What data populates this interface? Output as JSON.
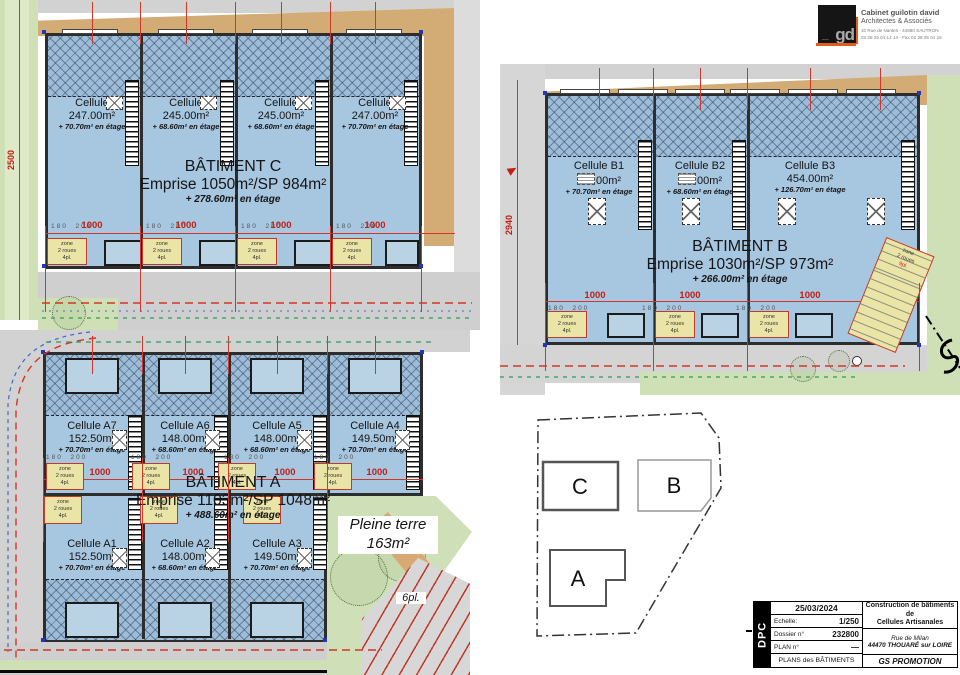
{
  "logo": {
    "monogram": "gd",
    "line1": "Cabinet guilotin david",
    "line2": "Architectes & Associés",
    "line3": "10 Rue de Nantes - 44880 SAUTRON",
    "line4": "02 28 25 01 14 14 - Fax 02 28 25 01 15"
  },
  "plan_c": {
    "title": "BÂTIMENT C",
    "emprise": "Emprise 1050m²/SP 984m²",
    "etage": "+ 278.60m² en étage",
    "side_dim": "2500",
    "dim_1000": "1000",
    "dim_pair": "180  200",
    "cells": [
      {
        "name": "Cellule",
        "area": "247.00m²",
        "floor": "+ 70.70m² en étage"
      },
      {
        "name": "Cellule",
        "area": "245.00m²",
        "floor": "+ 68.60m² en étage"
      },
      {
        "name": "Cellule",
        "area": "245.00m²",
        "floor": "+ 68.60m² en étage"
      },
      {
        "name": "Cellule",
        "area": "247.00m²",
        "floor": "+ 70.70m² en étage"
      }
    ]
  },
  "plan_b": {
    "title": "BÂTIMENT B",
    "emprise": "Emprise 1030m²/SP 973m²",
    "etage": "+ 266.00m² en étage",
    "side_dim": "2940",
    "dim_1000": "1000",
    "dim_pair": "180  200",
    "cells": [
      {
        "name": "Cellule B1",
        "area": "00m²",
        "floor": "+ 70.70m² en étage"
      },
      {
        "name": "Cellule B2",
        "area": "00m²",
        "floor": "+ 68.60m² en étage"
      },
      {
        "name": "Cellule B3",
        "area": "454.00m²",
        "floor": "+ 126.70m² en étage"
      }
    ]
  },
  "plan_a": {
    "title": "BÂTIMENT A",
    "emprise": "Emprise 1103m²/SP 1048m²",
    "etage": "+ 488.60m² en étage",
    "dim_1000": "1000",
    "dim_pair": "180  200",
    "cells_top": [
      {
        "name": "Cellule A7",
        "area": "152.50m²",
        "floor": "+ 70.70m² en étage"
      },
      {
        "name": "Cellule A6",
        "area": "148.00m²",
        "floor": "+ 68.60m² en étage"
      },
      {
        "name": "Cellule A5",
        "area": "148.00m²",
        "floor": "+ 68.60m² en étage"
      },
      {
        "name": "Cellule A4",
        "area": "149.50m²",
        "floor": "+ 70.70m² en étage"
      }
    ],
    "cells_bottom": [
      {
        "name": "Cellule A1",
        "area": "152.50m²",
        "floor": "+ 70.70m² en étage"
      },
      {
        "name": "Cellule A2",
        "area": "148.00m²",
        "floor": "+ 68.60m² en étage"
      },
      {
        "name": "Cellule A3",
        "area": "149.50m²",
        "floor": "+ 70.70m² en étage"
      }
    ],
    "pleine_terre_line1": "Pleine terre",
    "pleine_terre_line2": "163m²",
    "parking": "6pl."
  },
  "zone4": {
    "l1": "zone",
    "l2": "2 roues",
    "l3": "4pl."
  },
  "zone9": {
    "l1": "zone",
    "l2": "2 roues",
    "l3": "9pl."
  },
  "keyplan": {
    "a": "A",
    "b": "B",
    "c": "C"
  },
  "titleblock": {
    "dpc": "DPC",
    "date": "25/03/2024",
    "scale_label": "Echelle:",
    "scale_value": "1/250",
    "dossier_label": "Dossier n°",
    "dossier_value": "232800",
    "plan_label": "PLAN n°",
    "plan_value": "—",
    "footer": "PLANS des BÂTIMENTS",
    "project_line1": "Construction de bâtiments de",
    "project_line2": "Cellules Artisanales",
    "street": "Rue de Milan",
    "city": "44470 THOUARÉ sur LOIRE",
    "client": "GS PROMOTION"
  }
}
